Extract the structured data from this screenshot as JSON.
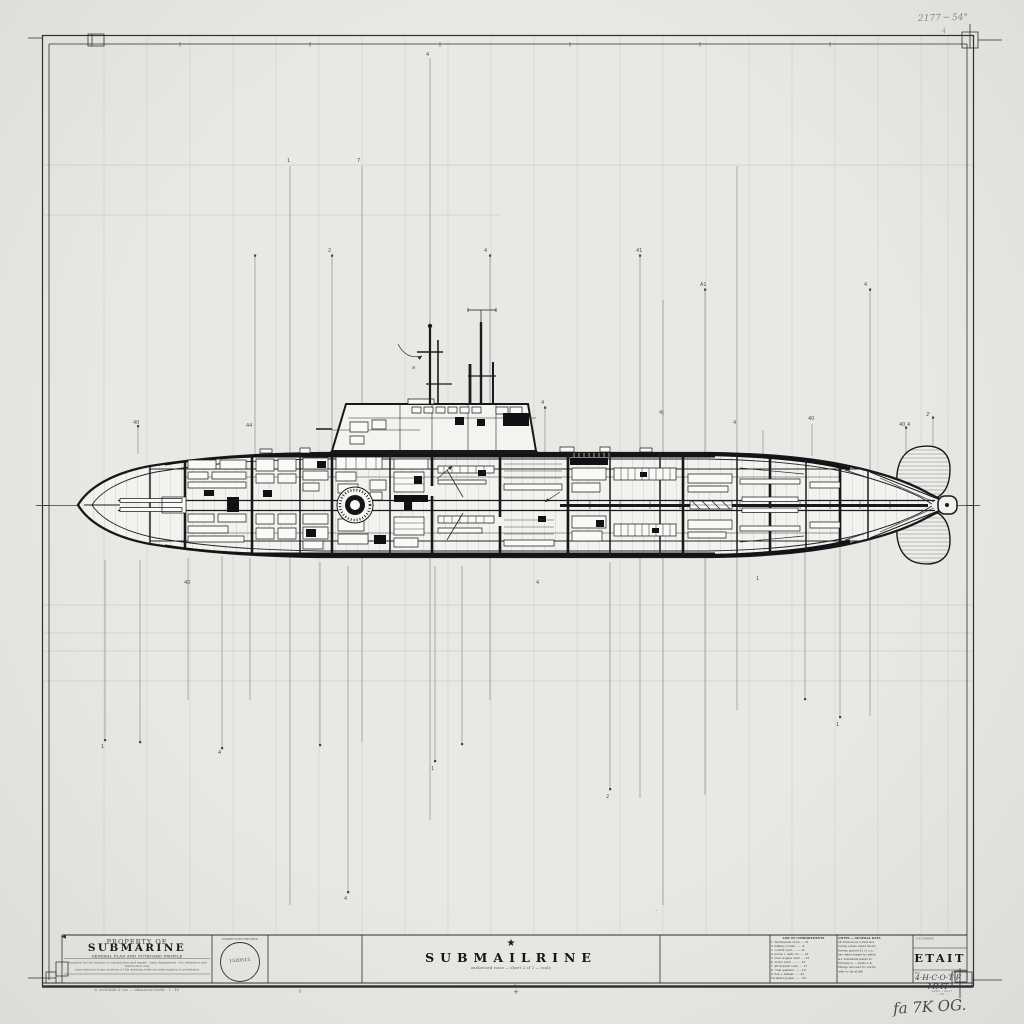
{
  "page": {
    "bg": "#e9e8e4",
    "ink": "#1f2023",
    "faint_line": "#bcbfc3",
    "pencil": "#85878b"
  },
  "annotations": {
    "top_right_pencil": "2177 ─  54°",
    "top_right_small": "4",
    "bottom_left_footer": "· w. archibald & son — submarine works ·            1 : 48",
    "bottom_center_tick": "+",
    "bottom_right_note1": "APPD — SK-11",
    "bottom_right_note2": "— 101 —",
    "bottom_right_signature": "fa 7K OG."
  },
  "title_block": {
    "left": {
      "eyebrow": "PROPERTY OF",
      "title": "SUBMARINE",
      "subtitle": "GENERAL PLAN AND OUTBOARD PROFILE",
      "line1": "prepared by the bureau of construction and repair · navy department · for reference and instruction only",
      "line2": "reproduction of any portion of this drawing without authorization is prohibited"
    },
    "stamp": {
      "header": "INSPECTOR'S RECORD",
      "number": "1520515"
    },
    "center": {
      "star": "★",
      "title": "SUBMAILRINE",
      "subtitle": "authorized issue — sheet 2 of 2 — scale"
    },
    "parts": {
      "header": "LIST OF COMPARTMENTS",
      "items": [
        "1  fwd torpedo room .... 7a",
        "2  battery compt ....... 9",
        "3  control room ........ 11",
        "4  pump + radio rm ..... 12",
        "5  main engine room .... 14",
        "6  motor room .......... 15",
        "7  aft torpedo room .... 17",
        "8  crew quarters ....... 19",
        "9  fuel + ballast ...... 21",
        "10 steering gear ....... 24"
      ]
    },
    "notes": {
      "header": "NOTES — GENERAL DATA",
      "lines": [
        "all dimensions in feet and",
        "inches unless noted herein.",
        "frames spaced 21 in. o.c.;",
        "see detail sheets for welds.",
        "w.t. bulkheads tested to",
        "50 lb/sq.in. — tanks 1–6.",
        "fittings removed for clarity,",
        "refer to list at left."
      ]
    },
    "right": {
      "header": "CUTAWAY",
      "big": "ETAIT",
      "no_label": "NO.",
      "sheet_value": "4·H·C·O·T·F  MMT"
    }
  },
  "drawing": {
    "micro_labels": [
      {
        "x": 133,
        "y": 424,
        "t": "40"
      },
      {
        "x": 246,
        "y": 427,
        "t": "44"
      },
      {
        "x": 287,
        "y": 162,
        "t": "1"
      },
      {
        "x": 357,
        "y": 162,
        "t": "7"
      },
      {
        "x": 328,
        "y": 252,
        "t": "2"
      },
      {
        "x": 426,
        "y": 56,
        "t": "4"
      },
      {
        "x": 484,
        "y": 252,
        "t": "4"
      },
      {
        "x": 541,
        "y": 404,
        "t": "4"
      },
      {
        "x": 636,
        "y": 252,
        "t": "41"
      },
      {
        "x": 659,
        "y": 414,
        "t": "4|"
      },
      {
        "x": 700,
        "y": 286,
        "t": "A1"
      },
      {
        "x": 733,
        "y": 424,
        "t": "4"
      },
      {
        "x": 808,
        "y": 420,
        "t": "40"
      },
      {
        "x": 864,
        "y": 286,
        "t": "4"
      },
      {
        "x": 899,
        "y": 426,
        "t": "40 4"
      },
      {
        "x": 926,
        "y": 416,
        "t": "2'"
      },
      {
        "x": 412,
        "y": 369,
        "t": "a"
      },
      {
        "x": 101,
        "y": 748,
        "t": "1"
      },
      {
        "x": 218,
        "y": 754,
        "t": "4"
      },
      {
        "x": 344,
        "y": 900,
        "t": "4"
      },
      {
        "x": 431,
        "y": 770,
        "t": "1"
      },
      {
        "x": 606,
        "y": 798,
        "t": "2"
      },
      {
        "x": 836,
        "y": 726,
        "t": "1"
      },
      {
        "x": 184,
        "y": 584,
        "t": "40"
      },
      {
        "x": 536,
        "y": 584,
        "t": "4"
      },
      {
        "x": 756,
        "y": 580,
        "t": "1"
      },
      {
        "x": 656,
        "y": 912,
        "t": "·"
      }
    ]
  }
}
